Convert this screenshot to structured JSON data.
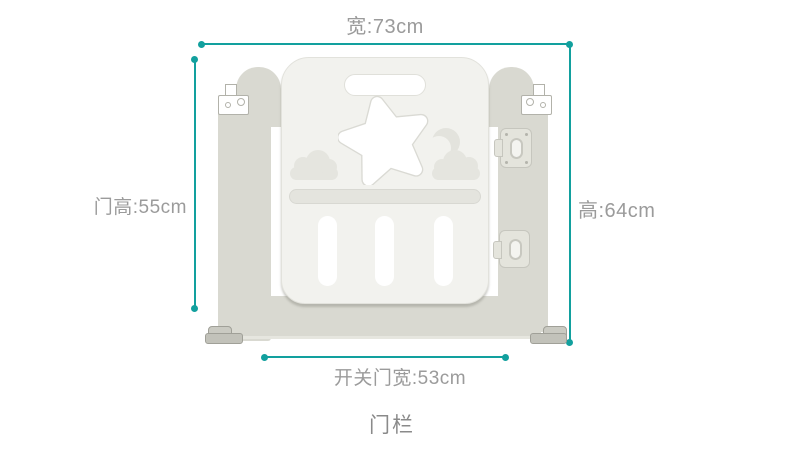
{
  "diagram": {
    "caption": "门栏",
    "measurements": {
      "width_label": "宽:73cm",
      "door_height_label": "门高:55cm",
      "height_label": "高:64cm",
      "door_width_label": "开关门宽:53cm"
    },
    "colors": {
      "dimension_line": "#12a09e",
      "measurement_text": "#9b9b9b",
      "caption_text": "#8a8a8a",
      "gate_frame": "#d9d9d1",
      "gate_door": "#f2f2ee",
      "cutout_white": "#ffffff",
      "decoration_gray": "#e5e5df"
    }
  }
}
